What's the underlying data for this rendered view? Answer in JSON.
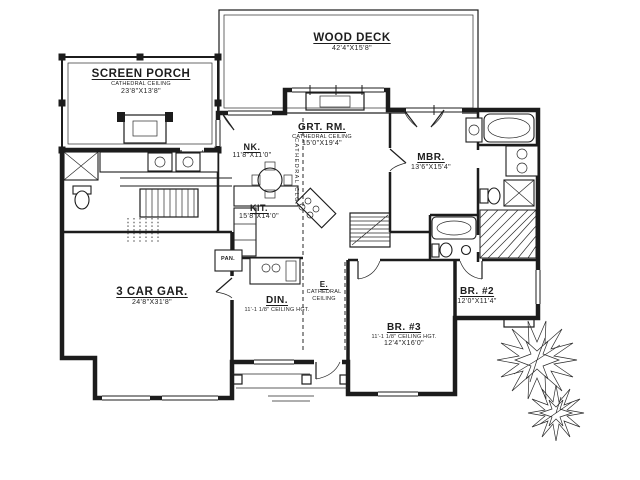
{
  "page": {
    "background": "#ffffff",
    "ink": "#1c1c1c",
    "description": "Single-story house floor plan drawing"
  },
  "plan": {
    "rooms": [
      {
        "id": "wood-deck",
        "name": "WOOD DECK",
        "dims": "42'4\"X15'8\""
      },
      {
        "id": "screen-porch",
        "name": "SCREEN PORCH",
        "ceiling": "CATHEDRAL CEILING",
        "dims": "23'8\"X13'8\""
      },
      {
        "id": "great-room",
        "name": "GRT. RM.",
        "ceiling": "CATHEDRAL CEILING",
        "dims": "15'0\"X19'4\""
      },
      {
        "id": "nook",
        "name": "NK.",
        "dims": "11'8\"X11'0\""
      },
      {
        "id": "master-bedroom",
        "name": "MBR.",
        "dims": "13'6\"X15'4\""
      },
      {
        "id": "kitchen",
        "name": "KIT.",
        "dims": "15'8\"X14'0\""
      },
      {
        "id": "garage",
        "name": "3 CAR GAR.",
        "dims": "24'8\"X31'8\""
      },
      {
        "id": "dining",
        "name": "DIN.",
        "ceiling": "11'-1 1/8\" CEILING HGT."
      },
      {
        "id": "entry",
        "name": "E.",
        "ceiling": "CATHEDRAL CEILING"
      },
      {
        "id": "bedroom-3",
        "name": "BR. #3",
        "ceiling": "11'-1 1/8\" CEILING HGT.",
        "dims": "12'4\"X16'0\""
      },
      {
        "id": "bedroom-2",
        "name": "BR. #2",
        "dims": "12'0\"X11'4\""
      }
    ],
    "annotations": [
      {
        "id": "pantry",
        "text": "PAN."
      },
      {
        "id": "cathedral-clg-vertical",
        "text": "CATHEDRAL CLG."
      }
    ]
  }
}
